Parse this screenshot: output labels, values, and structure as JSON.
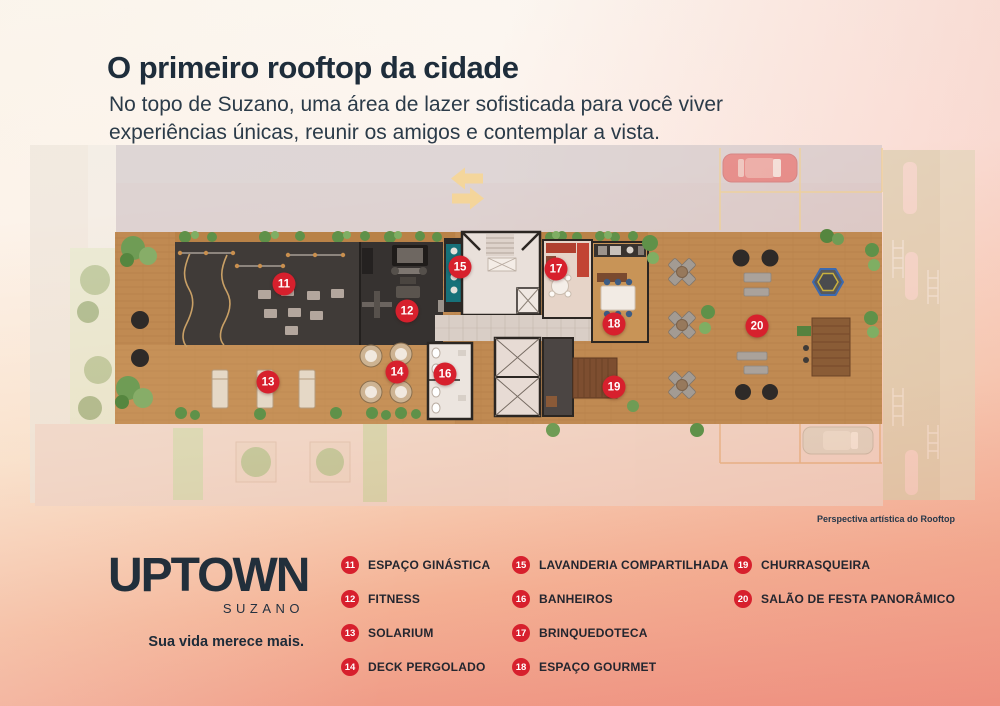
{
  "header": {
    "title": "O primeiro rooftop da cidade",
    "subtitle_line1": "No topo de Suzano, uma área de lazer sofisticada para você viver",
    "subtitle_line2": "experiências únicas, reunir os amigos e contemplar a vista."
  },
  "plan": {
    "caption": "Perspectiva artística do Rooftop",
    "markers": [
      {
        "number": "11",
        "x": 284,
        "y": 144
      },
      {
        "number": "12",
        "x": 407,
        "y": 171
      },
      {
        "number": "13",
        "x": 268,
        "y": 242
      },
      {
        "number": "14",
        "x": 397,
        "y": 232
      },
      {
        "number": "15",
        "x": 460,
        "y": 127
      },
      {
        "number": "16",
        "x": 445,
        "y": 234
      },
      {
        "number": "17",
        "x": 556,
        "y": 129
      },
      {
        "number": "18",
        "x": 614,
        "y": 184
      },
      {
        "number": "19",
        "x": 614,
        "y": 247
      },
      {
        "number": "20",
        "x": 757,
        "y": 186
      }
    ]
  },
  "brand": {
    "logo_main": "UPTOWN",
    "logo_sub": "SUZANO",
    "tagline": "Sua vida merece mais."
  },
  "legend": {
    "items": [
      {
        "num": "11",
        "label": "ESPAÇO GINÁSTICA"
      },
      {
        "num": "12",
        "label": "FITNESS"
      },
      {
        "num": "13",
        "label": "SOLARIUM"
      },
      {
        "num": "14",
        "label": "DECK PERGOLADO"
      },
      {
        "num": "15",
        "label": "LAVANDERIA COMPARTILHADA"
      },
      {
        "num": "16",
        "label": "BANHEIROS"
      },
      {
        "num": "17",
        "label": "BRINQUEDOTECA"
      },
      {
        "num": "18",
        "label": "ESPAÇO GOURMET"
      },
      {
        "num": "19",
        "label": "CHURRASQUEIRA"
      },
      {
        "num": "20",
        "label": "SALÃO DE FESTA PANORÂMICO"
      }
    ]
  },
  "colors": {
    "accent_red": "#d7202d",
    "title_navy": "#1e2d3b",
    "background_top": "#fbf7f1",
    "background_bottom": "#ee9181",
    "wood": "#c08a52",
    "gym_floor": "#403b38",
    "teal_laundry": "#177179"
  }
}
